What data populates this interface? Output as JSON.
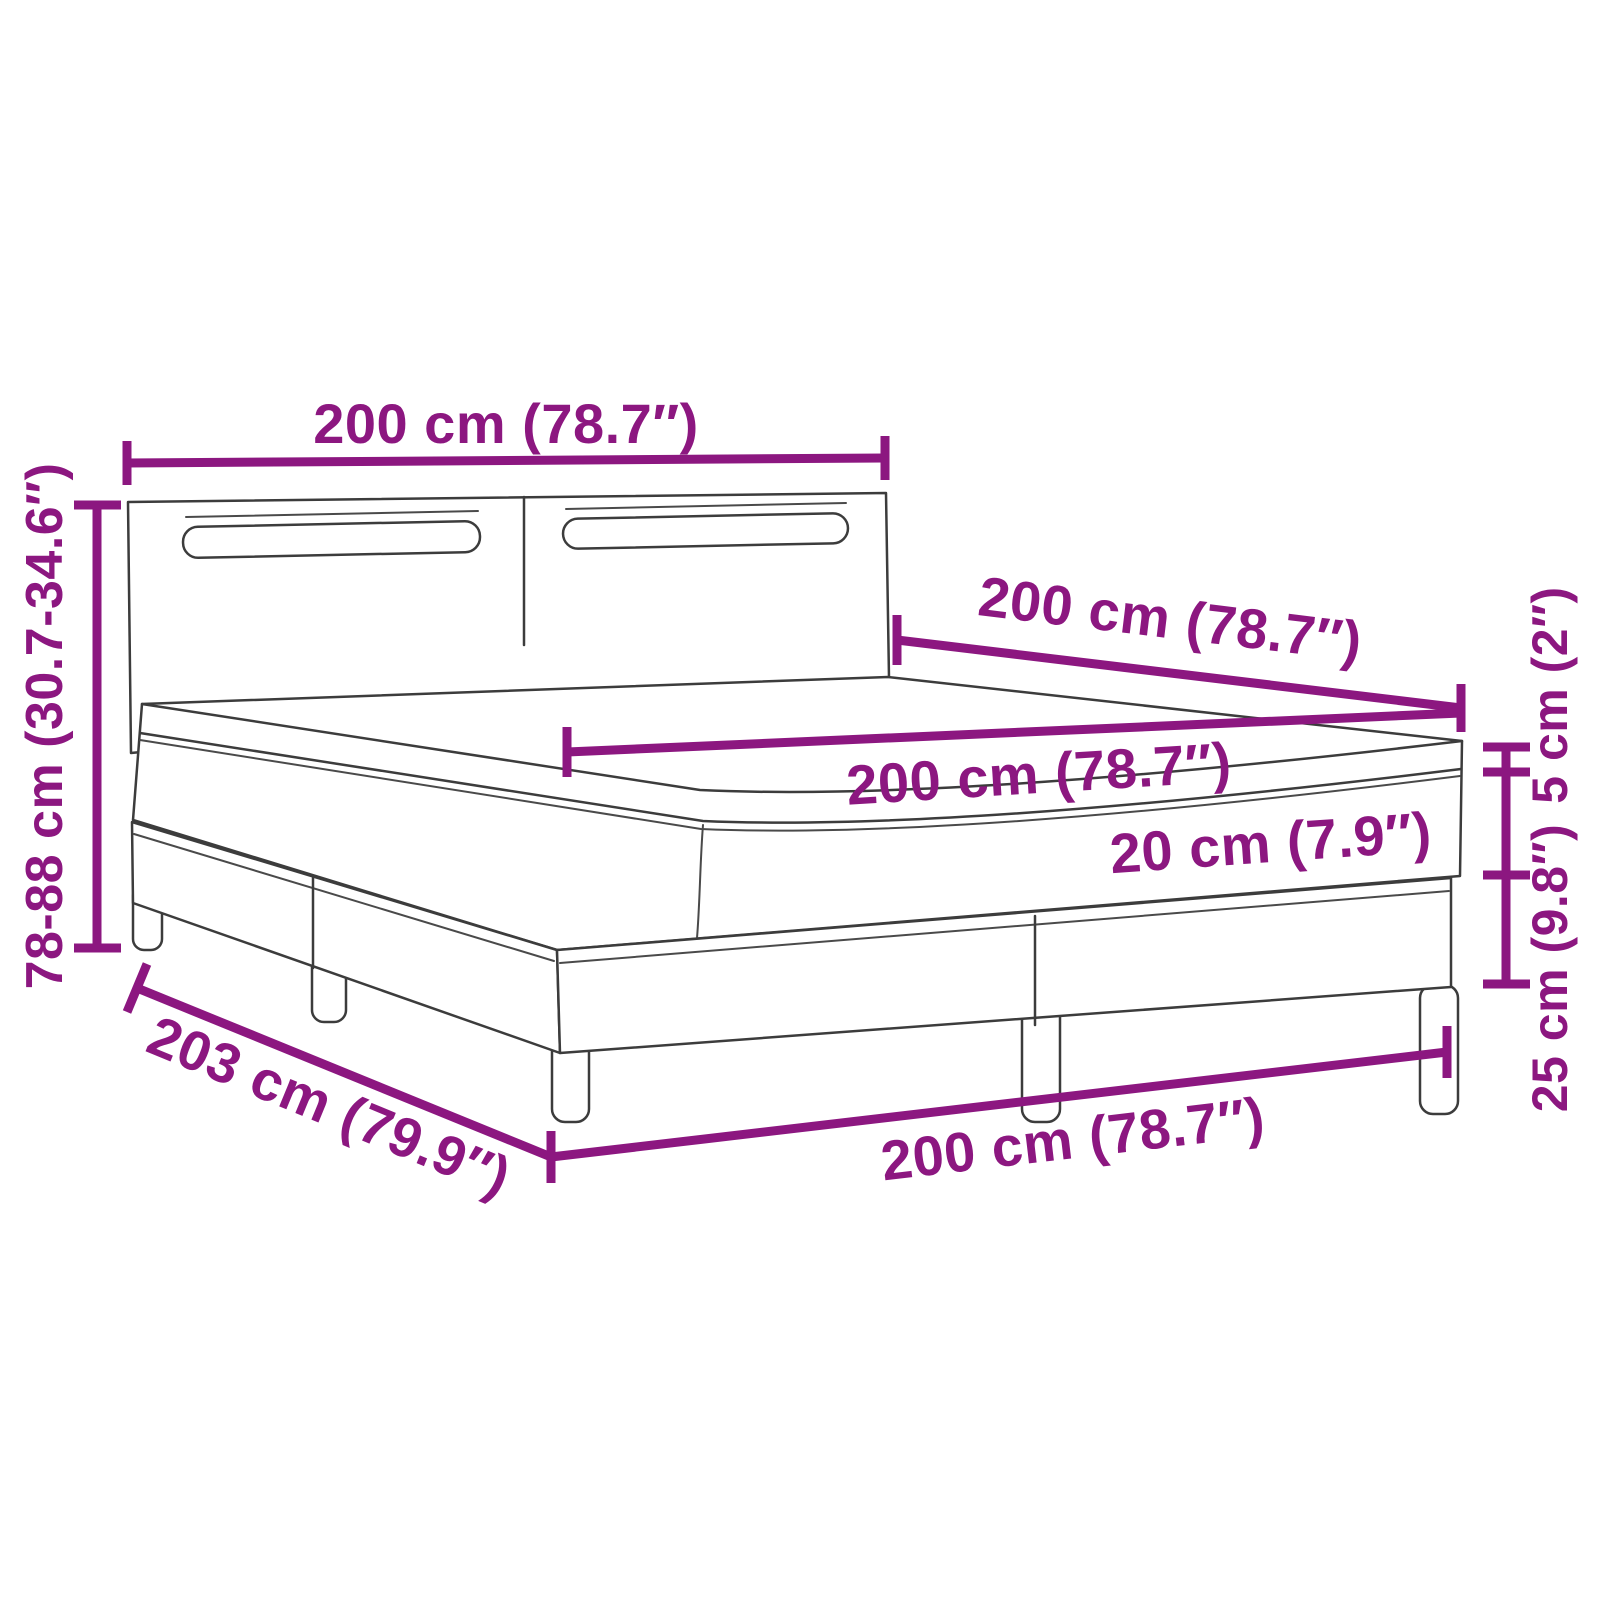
{
  "meta": {
    "title": "Box spring bed with LED headboard dimension diagram",
    "style": {
      "accent_color": "#8c1780",
      "outline_color": "#3c3c3c",
      "background_color": "#ffffff"
    }
  },
  "dims": {
    "headboard_width": "200 cm (78.7″)",
    "total_height": "78-88 cm (30.7-34.6″)",
    "bed_depth": "200 cm (78.7″)",
    "mattress_width": "200 cm (78.7″)",
    "mattress_thickness": "20 cm (7.9″)",
    "topper_thickness": "5 cm (2″)",
    "base_height": "25 cm (9.8″)",
    "base_depth": "203 cm (79.9″)",
    "base_width": "200 cm (78.7″)"
  }
}
